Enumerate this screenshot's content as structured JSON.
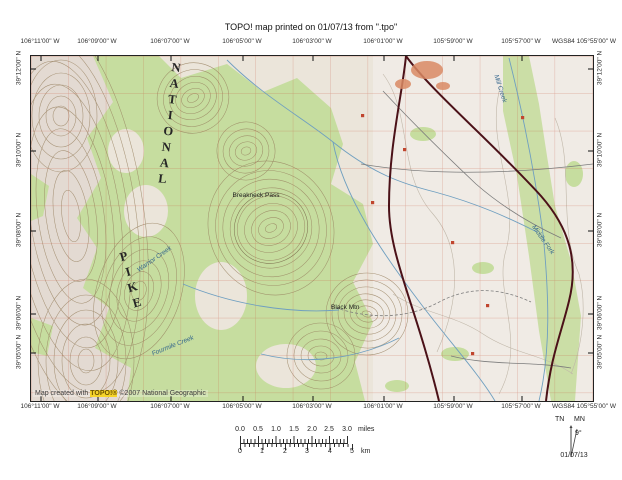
{
  "title": "TOPO! map printed on 01/07/13 from \".tpo\"",
  "map": {
    "top_coords": [
      "106°11'00\" W",
      "106°09'00\" W",
      "106°07'00\" W",
      "106°05'00\" W",
      "106°03'00\" W",
      "106°01'00\" W",
      "105°59'00\" W",
      "105°57'00\" W",
      "WGS84 105°55'00\" W"
    ],
    "bottom_coords": [
      "106°11'00\" W",
      "106°09'00\" W",
      "106°07'00\" W",
      "106°05'00\" W",
      "106°03'00\" W",
      "106°01'00\" W",
      "105°59'00\" W",
      "105°57'00\" W",
      "WGS84 105°55'00\" W"
    ],
    "left_coords": [
      "39°12'00\" N",
      "39°10'00\" N",
      "39°08'00\" N",
      "39°06'00\" N",
      "39°05'00\" N"
    ],
    "right_coords": [
      "39°12'00\" N",
      "39°10'00\" N",
      "39°08'00\" N",
      "39°06'00\" N",
      "39°05'00\" N"
    ],
    "labels": {
      "forest_word1": "PIKE",
      "forest_word2": "NATIONAL",
      "pass": "Breakneck Pass",
      "peak": "Black Mtn",
      "creek_mill": "Mill Creek",
      "creek_middle_fork": "Middle Fork",
      "creek_warrior": "Warrior Creek",
      "creek_fourmile": "Fourmile Creek"
    },
    "watermark": {
      "prefix": "Map created with ",
      "brand": "TOPO!®",
      "suffix": " ©2007 National Geographic"
    }
  },
  "scalebar": {
    "miles_ticks": [
      "0.0",
      "0.5",
      "1.0",
      "1.5",
      "2.0",
      "2.5",
      "3.0"
    ],
    "miles_unit": "miles",
    "km_ticks": [
      "0",
      "1",
      "2",
      "3",
      "4",
      "5"
    ],
    "km_unit": "km"
  },
  "declination": {
    "true_north": "TN",
    "magnetic_north": "MN",
    "angle": "9°",
    "date": "01/07/13"
  },
  "colors": {
    "forest_green": "#c6dd9f",
    "grid_red": "#c6563e",
    "highway_maroon": "#4b1118",
    "water_blue": "#6f9fc0",
    "brand_highlight": "#f6d42a"
  }
}
